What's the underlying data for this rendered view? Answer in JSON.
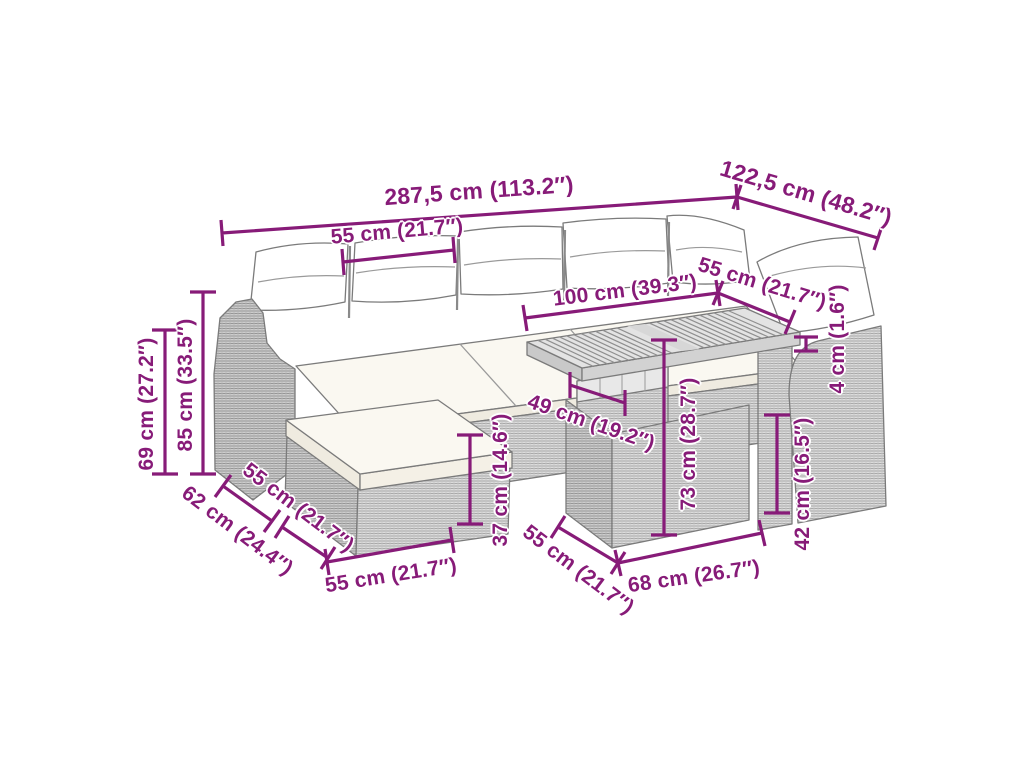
{
  "diagram": {
    "illustration": "rattan-corner-sofa-set-with-table-and-ottoman-line-art",
    "accent_color": "#871b78",
    "background_color": "#ffffff",
    "dimensions": [
      {
        "id": "overall-width",
        "label": "287,5 cm (113.2″)",
        "cm": 287.5,
        "inches": 113.2
      },
      {
        "id": "overall-depth",
        "label": "122,5 cm (48.2″)",
        "cm": 122.5,
        "inches": 48.2
      },
      {
        "id": "seat-section-width-left",
        "label": "55 cm (21.7″)",
        "cm": 55,
        "inches": 21.7
      },
      {
        "id": "table-length",
        "label": "100 cm (39.3″)",
        "cm": 100,
        "inches": 39.3
      },
      {
        "id": "seat-section-width-right",
        "label": "55 cm (21.7″)",
        "cm": 55,
        "inches": 21.7
      },
      {
        "id": "frame-height",
        "label": "69 cm (27.2″)",
        "cm": 69,
        "inches": 27.2
      },
      {
        "id": "total-height",
        "label": "85 cm (33.5″)",
        "cm": 85,
        "inches": 33.5
      },
      {
        "id": "sofa-depth",
        "label": "62 cm (24.4″)",
        "cm": 62,
        "inches": 24.4
      },
      {
        "id": "ottoman-depth",
        "label": "55 cm (21.7″)",
        "cm": 55,
        "inches": 21.7
      },
      {
        "id": "ottoman-width",
        "label": "55 cm (21.7″)",
        "cm": 55,
        "inches": 21.7
      },
      {
        "id": "seat-height",
        "label": "37 cm (14.6″)",
        "cm": 37,
        "inches": 14.6
      },
      {
        "id": "table-frame-depth",
        "label": "49 cm (19.2″)",
        "cm": 49,
        "inches": 19.2
      },
      {
        "id": "table-height",
        "label": "73 cm (28.7″)",
        "cm": 73,
        "inches": 28.7
      },
      {
        "id": "table-base-depth",
        "label": "55 cm (21.7″)",
        "cm": 55,
        "inches": 21.7
      },
      {
        "id": "table-base-width",
        "label": "68 cm (26.7″)",
        "cm": 68,
        "inches": 26.7
      },
      {
        "id": "chair-seat-height",
        "label": "42 cm (16.5″)",
        "cm": 42,
        "inches": 16.5
      },
      {
        "id": "tabletop-thickness",
        "label": "4 cm (1.6″)",
        "cm": 4,
        "inches": 1.6
      }
    ]
  }
}
